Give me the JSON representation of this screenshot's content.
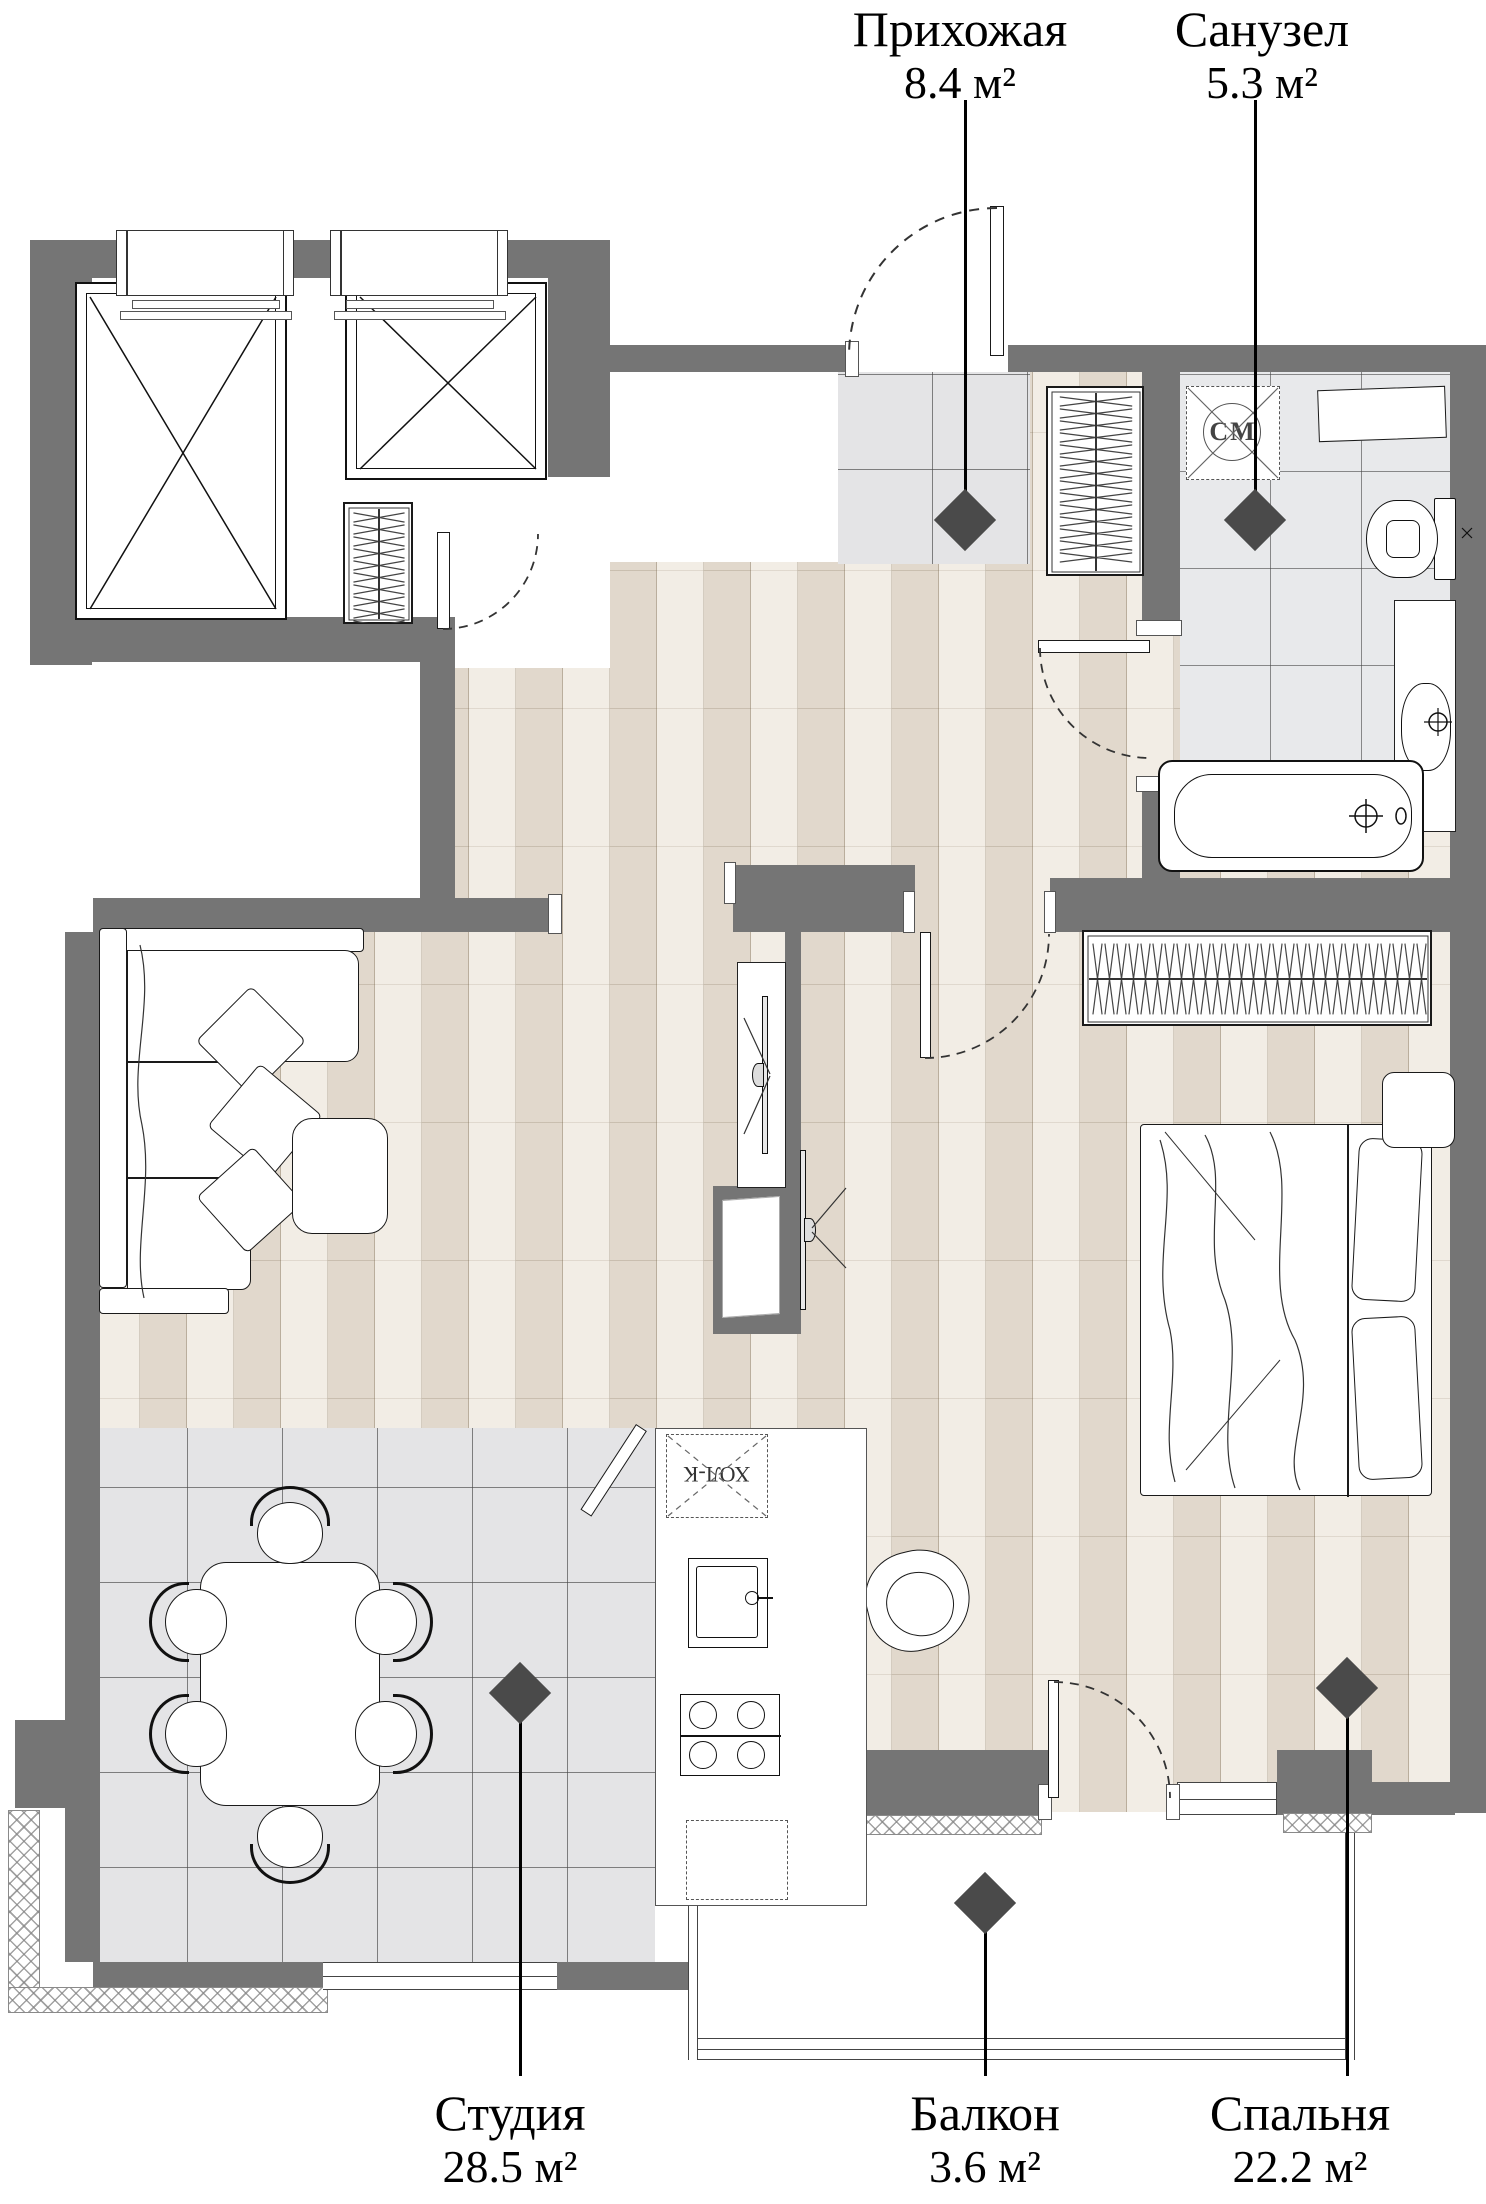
{
  "plan": {
    "title": "Floor plan of a studio apartment",
    "rooms": [
      {
        "id": "hallway",
        "name": "Прихожая",
        "area": "8.4 м²"
      },
      {
        "id": "bathroom",
        "name": "Санузел",
        "area": "5.3 м²"
      },
      {
        "id": "studio",
        "name": "Студия",
        "area": "28.5 м²"
      },
      {
        "id": "balcony",
        "name": "Балкон",
        "area": "3.6 м²"
      },
      {
        "id": "bedroom",
        "name": "Спальня",
        "area": "22.2 м²"
      }
    ],
    "appliance_labels": {
      "washing_machine": "СМ",
      "refrigerator": "ХОЛ-К"
    },
    "colors": {
      "wall": "#757575",
      "wood_floor": "#EDE5DA",
      "tile_floor": "#E4E4E6",
      "bath_tile": "#E8E9EB",
      "marker": "#4A4A4A",
      "outline": "#111111",
      "plank_line": "#C9C0B1"
    }
  }
}
